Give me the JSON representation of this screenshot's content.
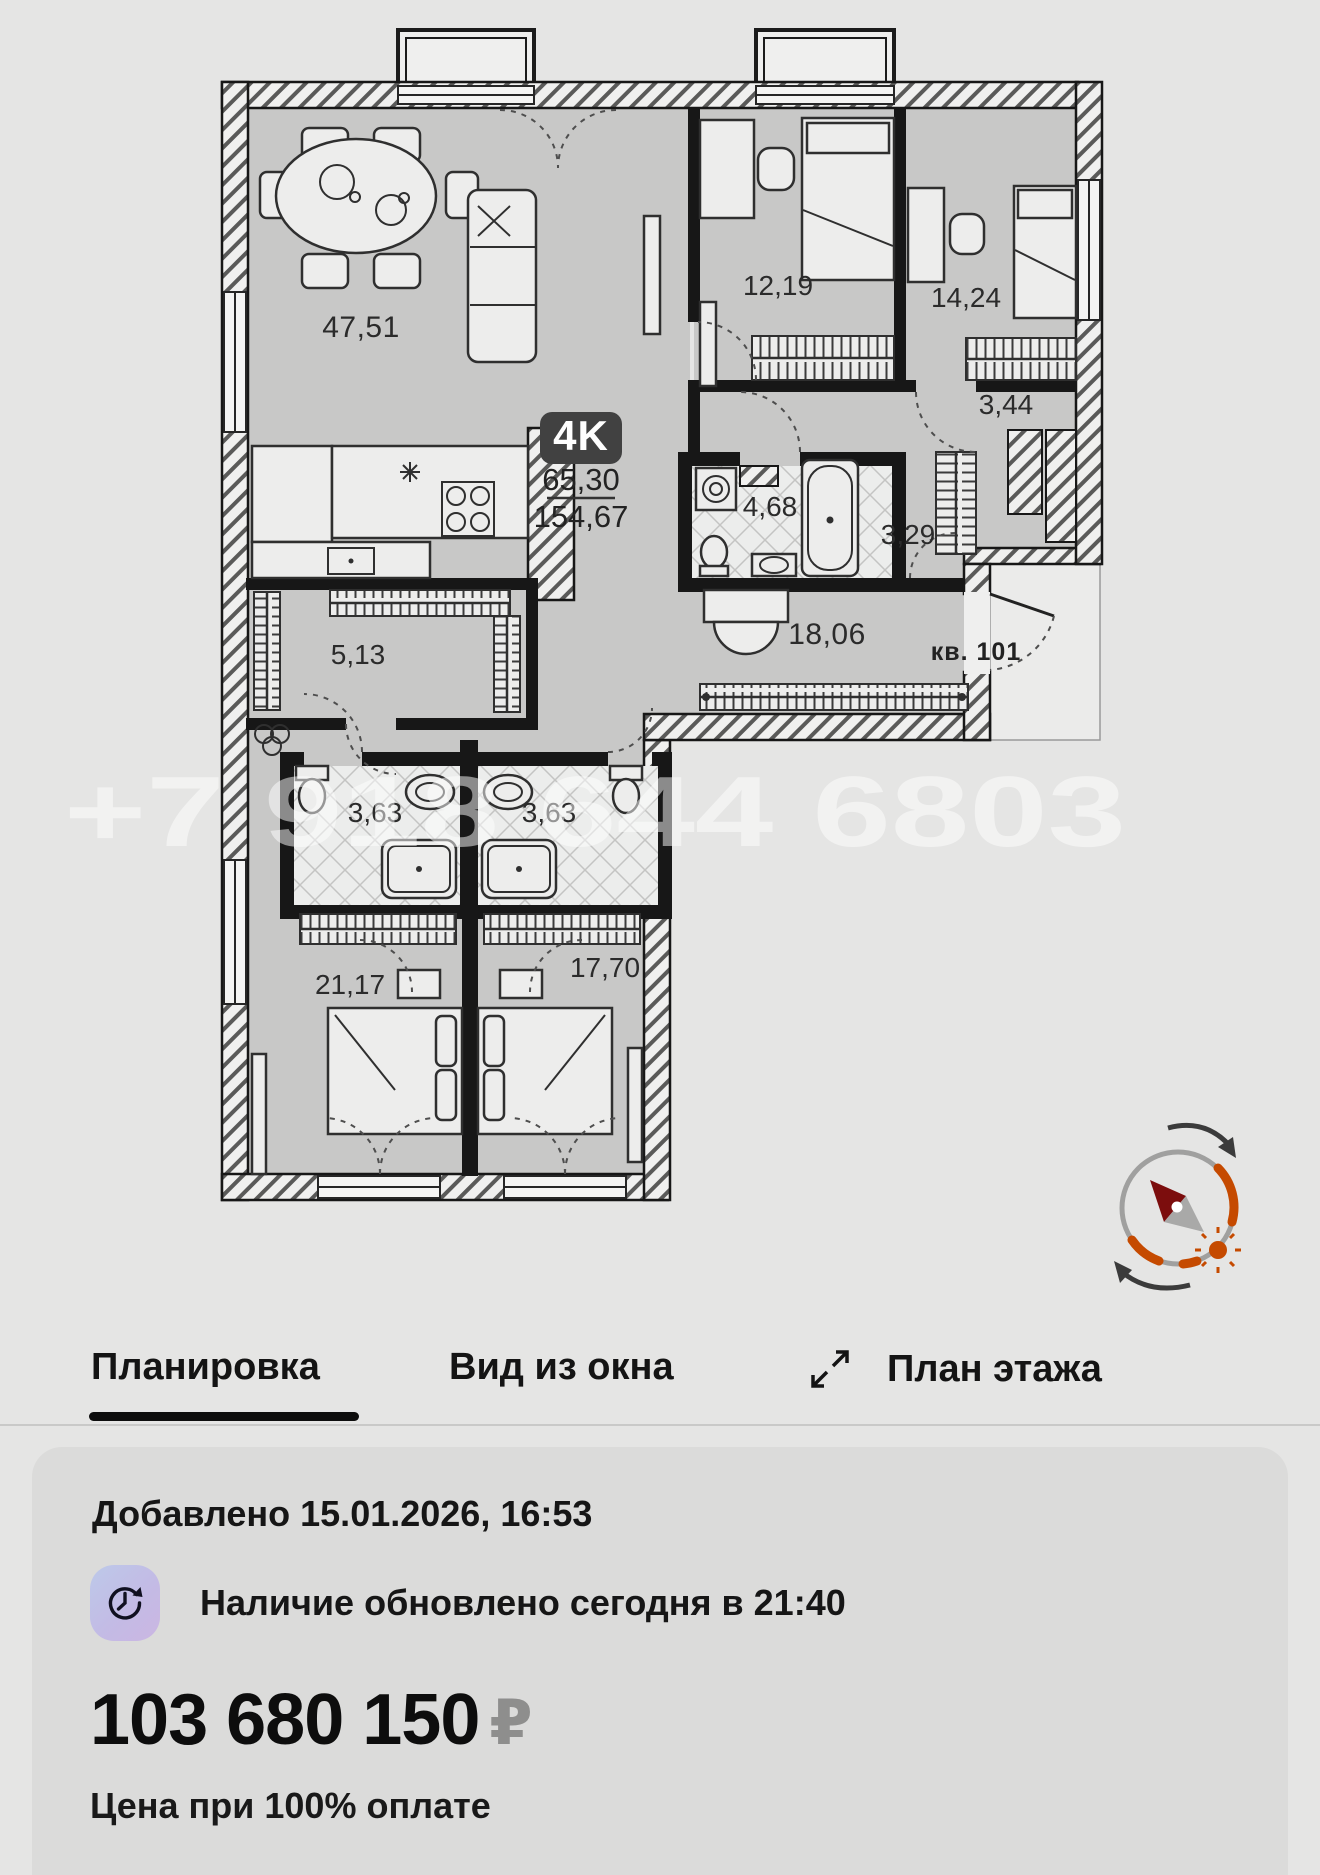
{
  "plan": {
    "type_badge": "4K",
    "living_area": "65,30",
    "total_area": "154,67",
    "apartment_label": "кв. 101",
    "watermark": "+7 918 644 6803",
    "rooms": [
      {
        "id": "living",
        "area": "47,51"
      },
      {
        "id": "bedroom-1",
        "area": "12,19"
      },
      {
        "id": "bedroom-2",
        "area": "14,24"
      },
      {
        "id": "closet",
        "area": "3,44"
      },
      {
        "id": "bathroom",
        "area": "4,68"
      },
      {
        "id": "corridor",
        "area": "3,29"
      },
      {
        "id": "hallway",
        "area": "18,06"
      },
      {
        "id": "pantry",
        "area": "5,13"
      },
      {
        "id": "bath-1",
        "area": "3,63"
      },
      {
        "id": "bath-2",
        "area": "3,63"
      },
      {
        "id": "bedroom-3",
        "area": "21,17"
      },
      {
        "id": "bedroom-4",
        "area": "17,70"
      }
    ],
    "colors": {
      "badge_bg": "#414141",
      "compass_orange": "#c54a00",
      "needle_red": "#7c0d0d"
    }
  },
  "tabs": {
    "planirovka": "Планировка",
    "vid_iz_okna": "Вид из окна",
    "plan_etazha": "План этажа"
  },
  "card": {
    "added": "Добавлено 15.01.2026, 16:53",
    "availability": "Наличие обновлено сегодня в 21:40",
    "price": "103 680 150",
    "currency": "₽",
    "price_note": "Цена при 100% оплате"
  }
}
